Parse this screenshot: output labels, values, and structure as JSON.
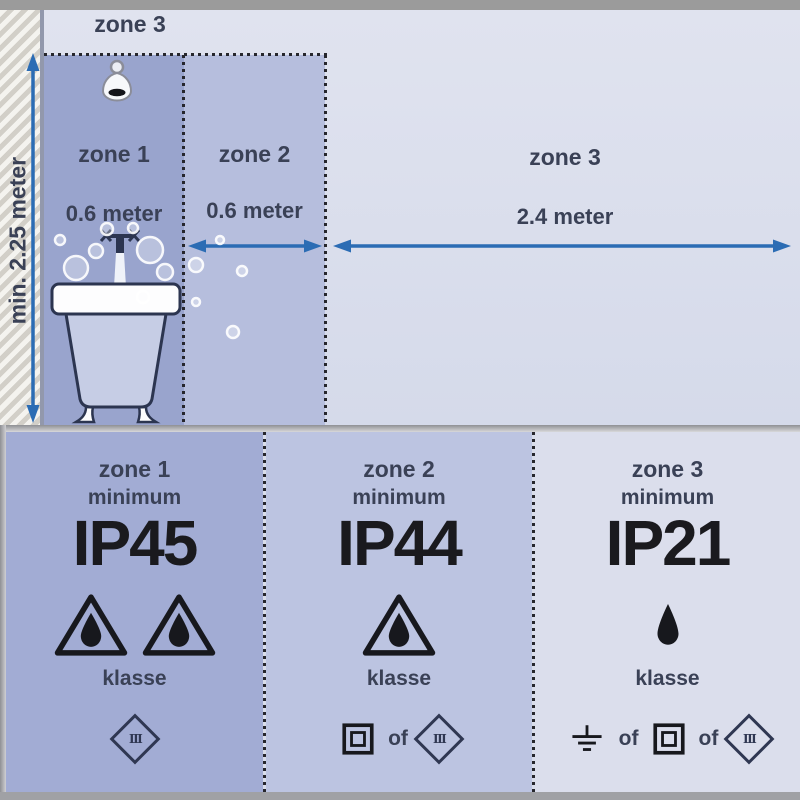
{
  "colors": {
    "zone1_fill": "#99a4cd",
    "zone2_fill": "#b6bedd",
    "zone3_fill": "#d9ddea",
    "panel1_fill": "#a2acd4",
    "panel2_fill": "#bcc4e1",
    "panel3_fill": "#dbdeec",
    "arrow_blue": "#2b6cb4",
    "label_text": "#3a4156",
    "ip_text": "#1a1a1e",
    "frame_gray": "#9b9b9b"
  },
  "plan": {
    "outer_zone_label": "zone 3",
    "wall_height_label": "min. 2.25 meter",
    "zones": [
      {
        "label": "zone 1",
        "distance": "0.6 meter"
      },
      {
        "label": "zone 2",
        "distance": "0.6 meter"
      },
      {
        "label": "zone 3",
        "distance": "2.4 meter"
      }
    ]
  },
  "panels": [
    {
      "zone": "zone 1",
      "minimum": "minimum",
      "ip_rating": "IP45",
      "klasse": "klasse",
      "protection_icons": [
        "water-drop-triangle",
        "water-drop-triangle"
      ],
      "allowed_classes": [
        "class-III-diamond"
      ],
      "class_numeral": "III"
    },
    {
      "zone": "zone 2",
      "minimum": "minimum",
      "ip_rating": "IP44",
      "klasse": "klasse",
      "or_word": "of",
      "protection_icons": [
        "water-drop-triangle"
      ],
      "allowed_classes": [
        "class-II-double-square",
        "class-III-diamond"
      ],
      "class_numeral": "III"
    },
    {
      "zone": "zone 3",
      "minimum": "minimum",
      "ip_rating": "IP21",
      "klasse": "klasse",
      "or_word": "of",
      "protection_icons": [
        "water-drop"
      ],
      "allowed_classes": [
        "class-I-earth",
        "class-II-double-square",
        "class-III-diamond"
      ],
      "class_numeral": "III"
    }
  ]
}
